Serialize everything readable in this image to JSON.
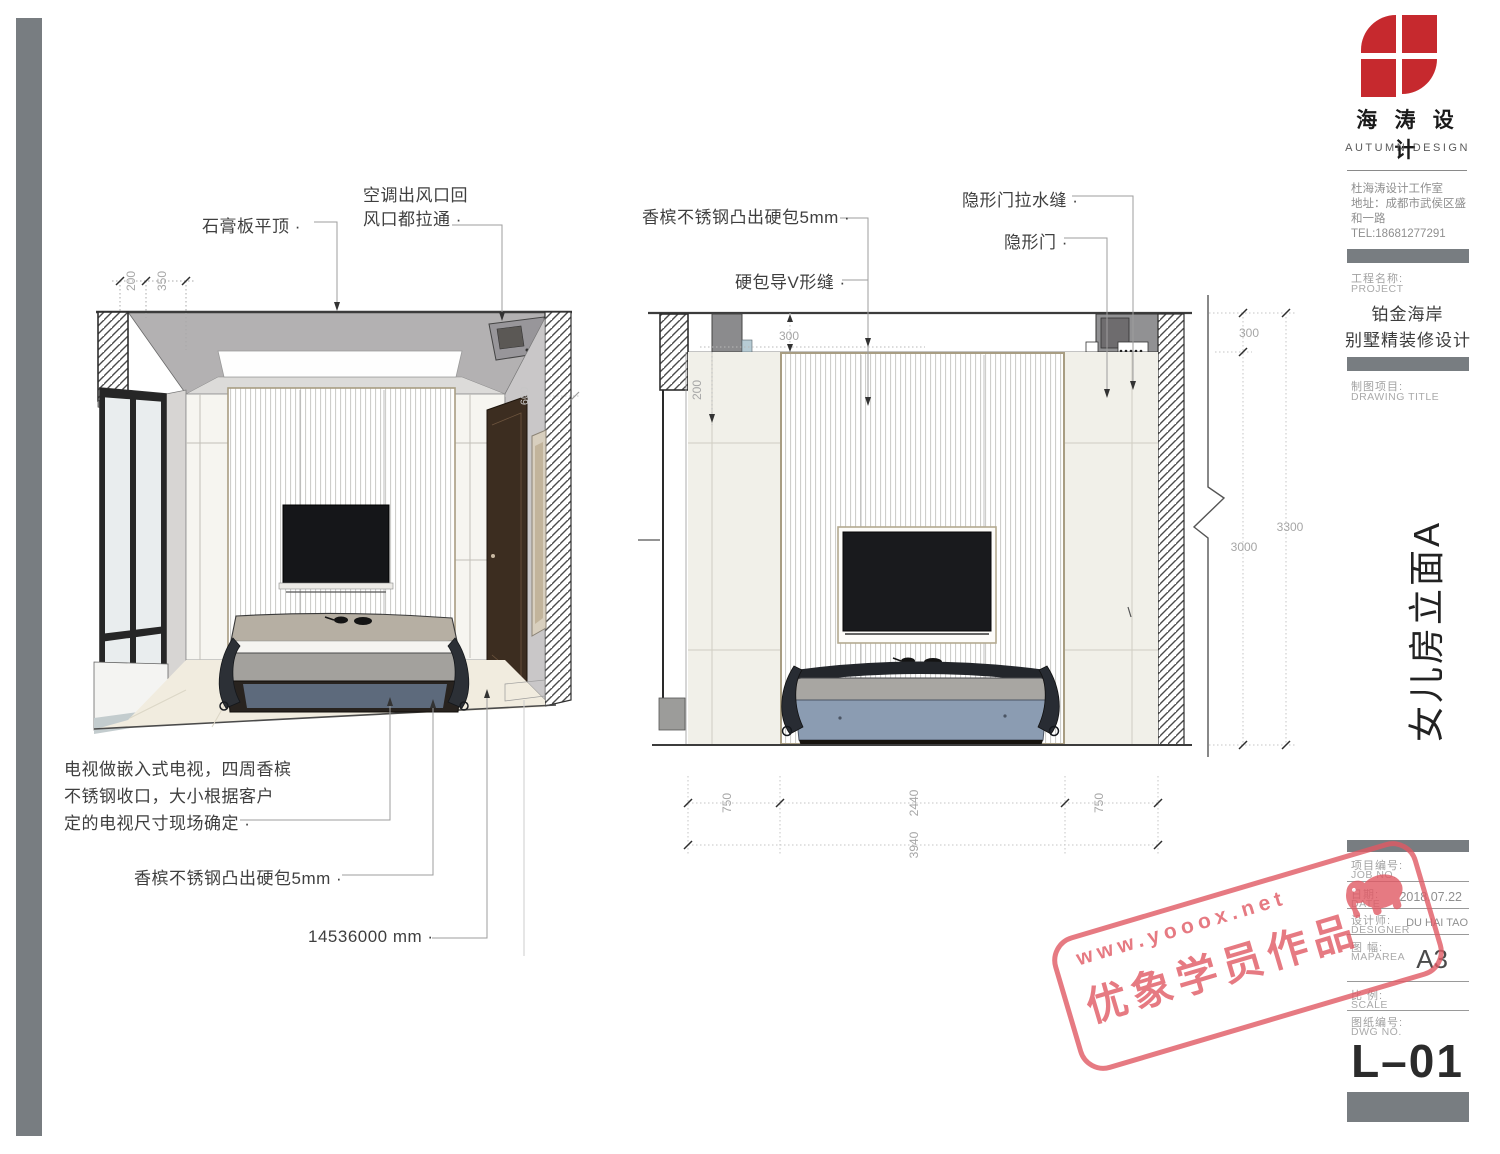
{
  "sheet": {
    "brand_cn": "海 涛 设 计",
    "brand_en": "AUTUMN DESIGN",
    "studio": "杜海涛设计工作室",
    "address": "地址：成都市武侯区盛和一路",
    "tel": "TEL:18681277291",
    "project_label_cn": "工程名称:",
    "project_label_en": "PROJECT",
    "project_line1": "铂金海岸",
    "project_line2": "别墅精装修设计",
    "drawing_label_cn": "制图项目:",
    "drawing_label_en": "DRAWING TITLE",
    "elevation_title": "女儿房立面A",
    "job_cn": "项目编号:",
    "job_en": "JOB NO.",
    "date_cn": "日期:",
    "date_en": "DATE",
    "date_val": "2018.07.22",
    "designer_cn": "设计师:",
    "designer_en": "DESIGNER",
    "designer_val": "DU HAI TAO",
    "size_cn": "图 幅:",
    "size_en": "MAPAREA",
    "size_val": "A3",
    "scale_cn": "比 例:",
    "scale_en": "SCALE",
    "dwg_cn": "图纸编号:",
    "dwg_en": "DWG NO.",
    "sheet_no": "L–01"
  },
  "left_view": {
    "ann_ceiling": "石膏板平顶 ·",
    "ann_ac1": "空调出风口回",
    "ann_ac2": "风口都拉通 ·",
    "note1": "电视做嵌入式电视，四周香槟",
    "note2": "不锈钢收口，大小根据客户",
    "note3": "定的电视尺寸现场确定 ·",
    "ann_hardpack": "香槟不锈钢凸出硬包5mm ·",
    "ann_size": "14536000 mm ·",
    "dim_200": "200",
    "dim_350": "350",
    "dim_600": "600"
  },
  "right_view": {
    "ann_hardpack": "香槟不锈钢凸出硬包5mm ·",
    "ann_vseam": "硬包导V形缝 ·",
    "ann_doorseam": "隐形门拉水缝 ·",
    "ann_door": "隐形门 ·",
    "dim_top300": "300",
    "dim_left200": "200",
    "dim_b750l": "750",
    "dim_b2440": "2440",
    "dim_b750r": "750",
    "dim_b3940": "3940",
    "dim_r300": "300",
    "dim_r3000": "3000",
    "dim_r3300": "3300"
  },
  "watermark": {
    "url": "www.yooox.net",
    "label": "优象学员作品",
    "color": "#e15964"
  },
  "colors": {
    "accent_red": "#c6292e",
    "bar_gray": "#787d81",
    "panel_cream": "#f1f0e9",
    "bed_blue": "#8b9cb2",
    "door_brown": "#3c2d20"
  }
}
